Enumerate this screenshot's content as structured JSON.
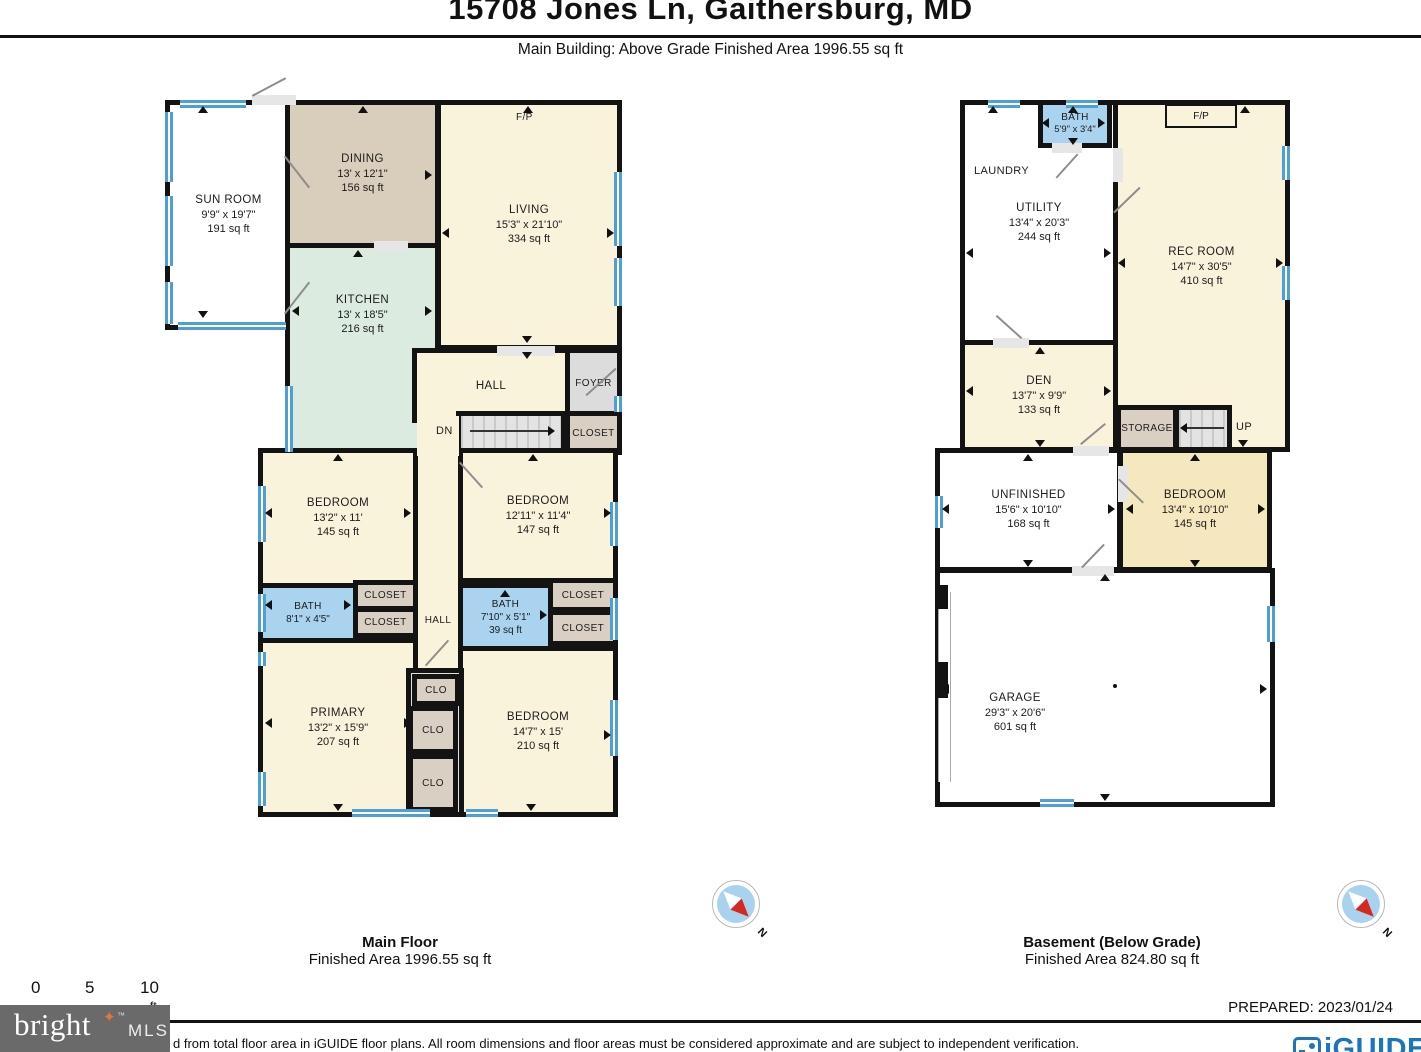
{
  "header": {
    "title": "15708 Jones Ln, Gaithersburg, MD",
    "subtitle": "Main Building: Above Grade Finished Area 1996.55 sq ft"
  },
  "labels": {
    "closet": "CLOSET",
    "clo": "CLO",
    "hall": "HALL",
    "foyer": "FOYER",
    "laundry": "LAUNDRY",
    "storage": "STORAGE",
    "dn": "DN",
    "up": "UP",
    "fp": "F/P"
  },
  "main_floor": {
    "caption": "Main Floor",
    "caption_area": "Finished Area 1996.55 sq ft",
    "rooms": {
      "sun_room": {
        "name": "SUN ROOM",
        "dims": "9'9\" x 19'7\"",
        "area": "191 sq ft"
      },
      "dining": {
        "name": "DINING",
        "dims": "13' x 12'1\"",
        "area": "156 sq ft"
      },
      "living": {
        "name": "LIVING",
        "dims": "15'3\" x 21'10\"",
        "area": "334 sq ft"
      },
      "kitchen": {
        "name": "KITCHEN",
        "dims": "13' x 18'5\"",
        "area": "216 sq ft"
      },
      "bedroom_left": {
        "name": "BEDROOM",
        "dims": "13'2\" x 11'",
        "area": "145 sq ft"
      },
      "bedroom_right": {
        "name": "BEDROOM",
        "dims": "12'11\" x 11'4\"",
        "area": "147 sq ft"
      },
      "bath_left": {
        "name": "BATH",
        "dims": "8'1\" x 4'5\""
      },
      "bath_right": {
        "name": "BATH",
        "dims": "7'10\" x 5'1\"",
        "area": "39 sq ft"
      },
      "primary": {
        "name": "PRIMARY",
        "dims": "13'2\" x 15'9\"",
        "area": "207 sq ft"
      },
      "bedroom_bottom": {
        "name": "BEDROOM",
        "dims": "14'7\" x 15'",
        "area": "210 sq ft"
      }
    }
  },
  "basement": {
    "caption": "Basement (Below Grade)",
    "caption_area": "Finished Area 824.80 sq ft",
    "rooms": {
      "bath": {
        "name": "BATH",
        "dims": "5'9\" x 3'4\""
      },
      "utility": {
        "name": "UTILITY",
        "dims": "13'4\" x 20'3\"",
        "area": "244 sq ft"
      },
      "rec_room": {
        "name": "REC ROOM",
        "dims": "14'7\" x 30'5\"",
        "area": "410 sq ft"
      },
      "den": {
        "name": "DEN",
        "dims": "13'7\" x 9'9\"",
        "area": "133 sq ft"
      },
      "unfinished": {
        "name": "UNFINISHED",
        "dims": "15'6\" x 10'10\"",
        "area": "168 sq ft"
      },
      "bedroom": {
        "name": "BEDROOM",
        "dims": "13'4\" x 10'10\"",
        "area": "145 sq ft"
      },
      "garage": {
        "name": "GARAGE",
        "dims": "29'3\" x 20'6\"",
        "area": "601 sq ft"
      }
    }
  },
  "footer": {
    "scale_ticks": [
      "0",
      "5",
      "10"
    ],
    "scale_unit": "ft",
    "prepared": "PREPARED: 2023/01/24",
    "disclaimer": "d from total floor area in iGUIDE floor plans. All room dimensions and floor areas must be considered approximate and are subject to independent verification.",
    "compass_n": "N",
    "brand": {
      "bright": "bright",
      "mls": "MLS",
      "tm": "™"
    },
    "iguide": "iGUIDE"
  },
  "colors": {
    "wall": "#131313",
    "cream": "#FAF3DC",
    "dining_tan": "#D9CDBB",
    "kitchen_mint": "#DCEBDF",
    "bath_blue": "#A9D3EE",
    "closet_tan": "#D9D0C3",
    "foyer_gray": "#DCDCDC",
    "window_blue": "#4E9FD4",
    "bedroom_yellow": "#F6E8BE",
    "brand_orange": "#E8743B",
    "iguide_blue": "#1B75BC"
  }
}
